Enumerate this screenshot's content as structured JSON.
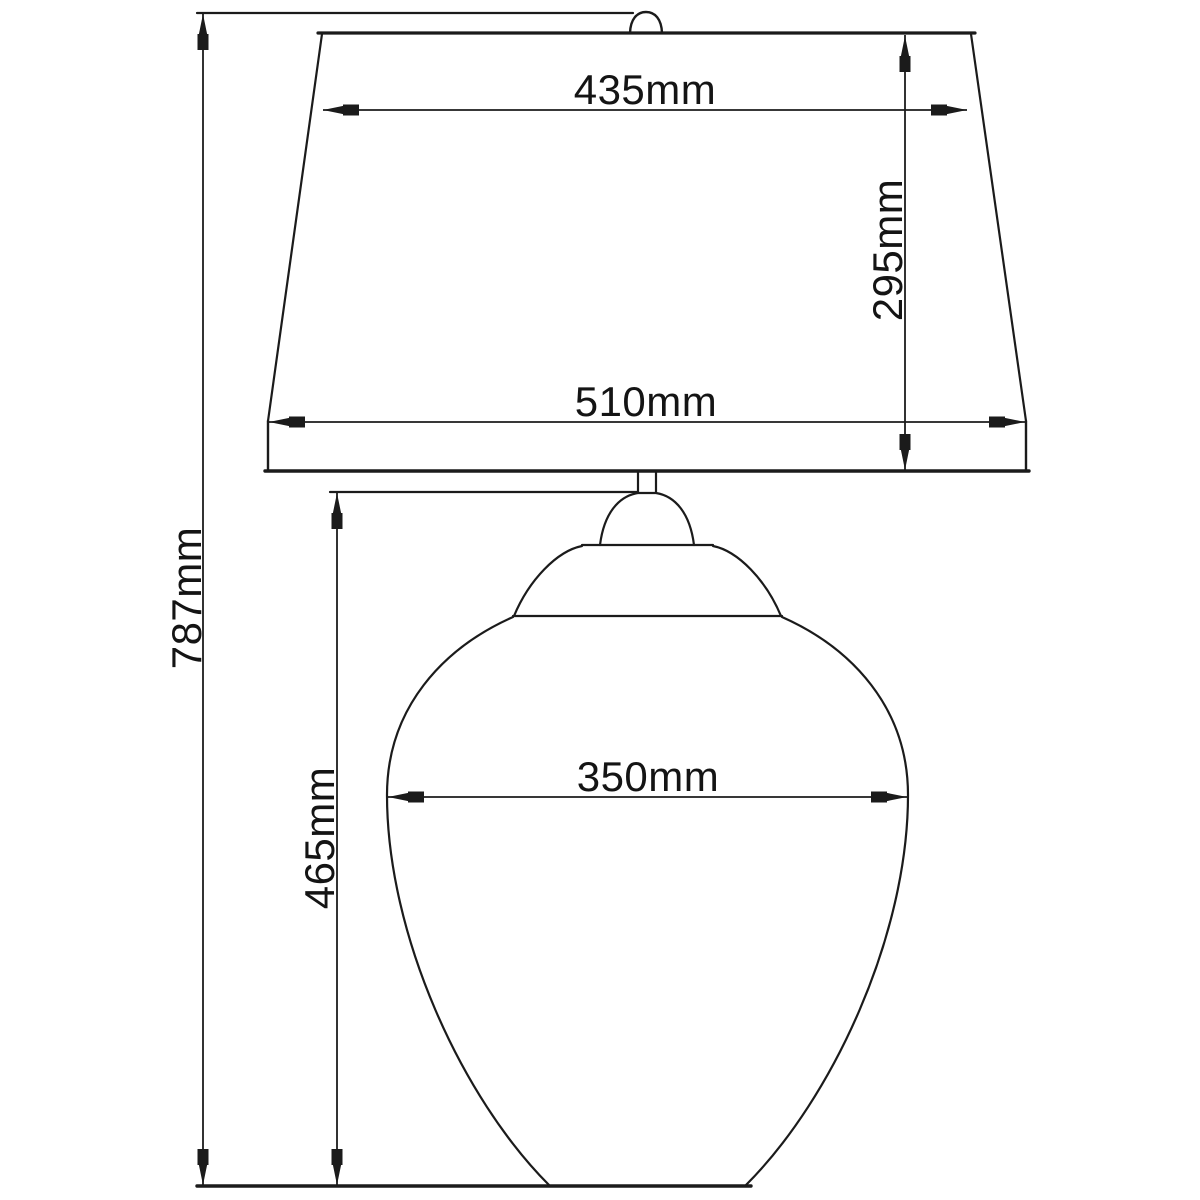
{
  "page": {
    "background_color": "#ffffff"
  },
  "drawing": {
    "type": "technical-dimension-diagram",
    "subject": "table-lamp-with-shade",
    "unit": "mm",
    "line_color": "#1b1b1b",
    "text_color": "#141414",
    "dimensions": {
      "shade_top_width": {
        "value": 435,
        "unit": "mm",
        "label": "435mm"
      },
      "shade_height": {
        "value": 295,
        "unit": "mm",
        "label": "295mm"
      },
      "shade_bottom_width": {
        "value": 510,
        "unit": "mm",
        "label": "510mm"
      },
      "overall_height": {
        "value": 787,
        "unit": "mm",
        "label": "787mm"
      },
      "body_width": {
        "value": 350,
        "unit": "mm",
        "label": "350mm"
      },
      "body_height": {
        "value": 465,
        "unit": "mm",
        "label": "465mm"
      }
    }
  }
}
